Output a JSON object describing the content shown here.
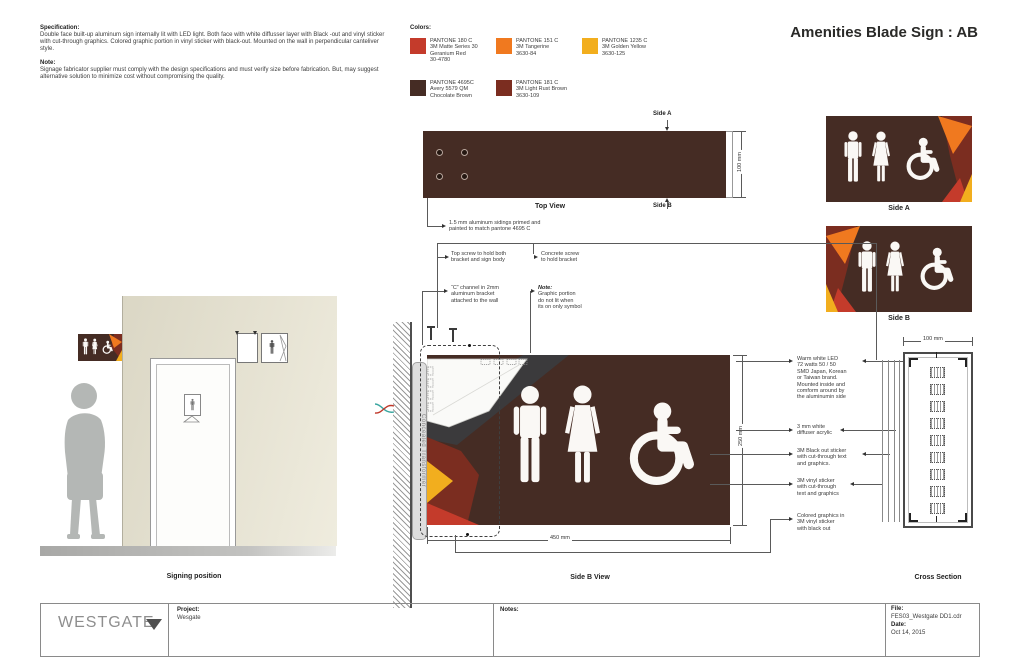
{
  "title": "Amenities Blade Sign : AB",
  "spec": {
    "heading": "Specification:",
    "body": "Double face built-up aluminum sign internally lit with LED light. Both face with white diffusser layer with Black -out and vinyl sticker with cut-through graphics. Colored graphic portion in vinyl sticker with black-out. Mounted on the wall in perpendicular canteliver style.",
    "note_heading": "Note:",
    "note_body": "Signage fabricator supplier must comply with the design specifications and must verify size before fabrication. But, may suggest alternative solution to minimize cost without compromising the quality."
  },
  "colors_panel": {
    "heading": "Colors:",
    "swatches": [
      {
        "hex": "#C43B2B",
        "text": "PANTONE 180 C\n3M Matte Series 30\nGeranium Red\n30-4780"
      },
      {
        "hex": "#F0791F",
        "text": "PANTONE 151 C\n3M Tangerine\n3630-84"
      },
      {
        "hex": "#F2AE1E",
        "text": "PANTONE 1235 C\n3M  Golden Yellow\n3630-125"
      },
      {
        "hex": "#452C24",
        "text": "PANTONE 4695C\nAvery 5579 QM\nChocolate Brown"
      },
      {
        "hex": "#7B2D20",
        "text": "PANTONE 181 C\n3M Light Rust Brown\n3630-109"
      }
    ]
  },
  "palette": {
    "brown": "#452C24",
    "rust": "#7B2D20",
    "red": "#C43B2B",
    "orange": "#F0791F",
    "yellow": "#F2AE1E",
    "gray_wedge": "#3B3A3C"
  },
  "top_view": {
    "caption": "Top View",
    "side_a_label": "Side A",
    "side_b_label": "Side B",
    "dim": "100 mm",
    "callout": "1.5 mm aluminum sidings primed and\npainted to match pantone 4695 C"
  },
  "previews": {
    "side_a_caption": "Side A",
    "side_b_caption": "Side B"
  },
  "side_b_view": {
    "caption": "Side B View",
    "dim_w": "450 mm",
    "dim_h": "250 mm",
    "transformer_label": "Concealed  Transformer",
    "callout_top_screw": "Top screw to hold both\nbracket and sign body",
    "callout_concrete": "Concrete screw\nto hold bracket",
    "callout_channel": "“C” channel in 2mm\naluminum bracket\nattached to the wall",
    "note_label": "Note:",
    "note_text": "Graphic portion\ndo not lit when\nits on only symbol",
    "callout_led": "Warm white LED\n72 watts  50 / 50\nSMD Japan, Korean\nor  Taiwan brand.\nMounted inside and\ncomform around by\nthe aluminumin side",
    "callout_diffuser": "3 mm white\ndiffuser acrylic",
    "callout_blackout": "3M Black out sticker\nwith cut-through text\nand graphics.",
    "callout_vinyl": "3M vinyl  sticker\nwith cut-through\ntext and graphics",
    "callout_colored": "Colored graphics in\n3M vinyl sticker\nwith black out"
  },
  "cross_section": {
    "caption": "Cross Section",
    "dim": "100 mm"
  },
  "elevation": {
    "caption": "Signing position"
  },
  "footer": {
    "logo": "WESTGATE",
    "project_label": "Project:",
    "project_value": "Wesgate",
    "notes_label": "Notes:",
    "file_label": "File:",
    "file_value": "FES03_Westgate DD1.cdr",
    "date_label": "Date:",
    "date_value": "Oct 14,  2015"
  }
}
